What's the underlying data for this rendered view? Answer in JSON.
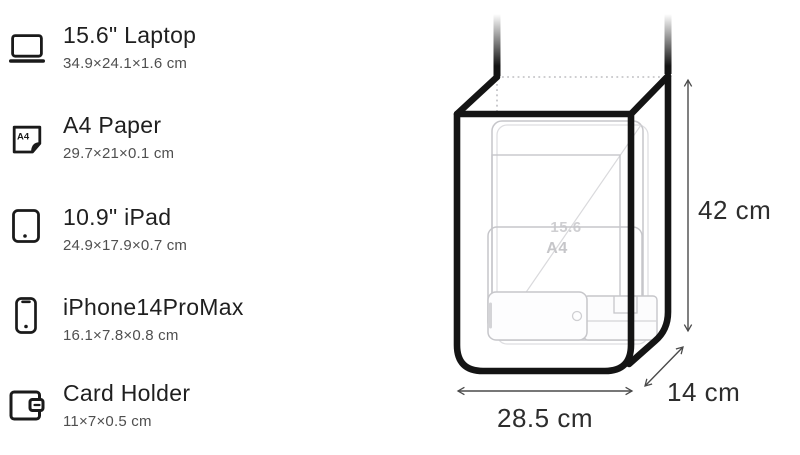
{
  "items": [
    {
      "label": "15.6\" Laptop",
      "dims": "34.9×24.1×1.6 cm",
      "icon": "laptop-icon"
    },
    {
      "label": "A4 Paper",
      "dims": "29.7×21×0.1 cm",
      "icon": "a4-paper-icon",
      "icon_text": "A4"
    },
    {
      "label": "10.9\" iPad",
      "dims": "24.9×17.9×0.7 cm",
      "icon": "ipad-icon"
    },
    {
      "label": "iPhone14ProMax",
      "dims": "16.1×7.8×0.8 cm",
      "icon": "iphone-icon"
    },
    {
      "label": "Card Holder",
      "dims": "11×7×0.5 cm",
      "icon": "card-holder-icon"
    }
  ],
  "diagram": {
    "height_label": "42 cm",
    "width_label": "28.5 cm",
    "depth_label": "14 cm",
    "ghost_items": {
      "laptop_label": "15.6",
      "a4_label": "A4"
    },
    "colors": {
      "bag_outline": "#141414",
      "ghost_outline": "#c6c6ca",
      "dimension_line": "#4a4a4a",
      "dimension_text": "#2d2d2d",
      "dotted_line": "#bdbdc1"
    }
  }
}
